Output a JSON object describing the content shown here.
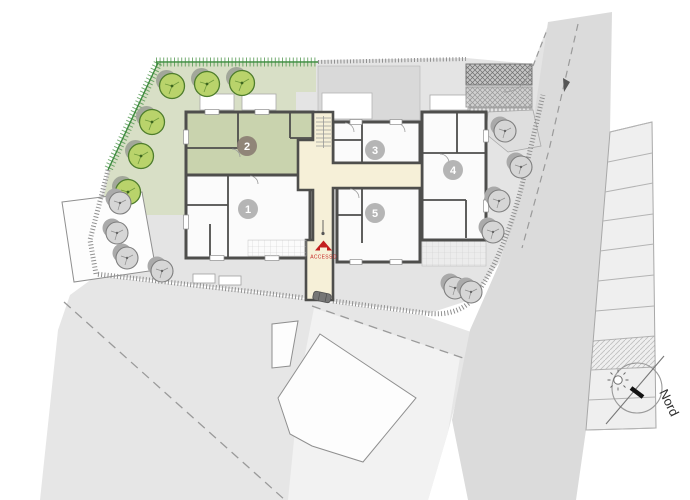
{
  "plan": {
    "apartments": [
      {
        "number": "1",
        "highlighted": false
      },
      {
        "number": "2",
        "highlighted": true
      },
      {
        "number": "3",
        "highlighted": false
      },
      {
        "number": "4",
        "highlighted": false
      },
      {
        "number": "5",
        "highlighted": false
      }
    ],
    "access": {
      "label": "ACCESSO"
    },
    "compass": {
      "north_label": "Nord"
    },
    "icons": [
      "tree-icon",
      "sun-icon",
      "car-icon",
      "access-arrow-icon",
      "north-compass-icon"
    ],
    "colors": {
      "highlight_unit_green": "#c9d3ae",
      "garden_green": "#d8dfc6",
      "tree_green": "#b9d36b",
      "tree_green_stroke": "#4e7d2c",
      "corridor_cream": "#f6f0d8",
      "wall_dark": "#4e4e4c",
      "access_red": "#c31f1f",
      "site_gray": "#e4e4e4",
      "road_gray": "#dbdbdb",
      "fence_green": "#4a9247",
      "badge_gray": "#adadad",
      "badge_brown": "#8d8175"
    }
  }
}
